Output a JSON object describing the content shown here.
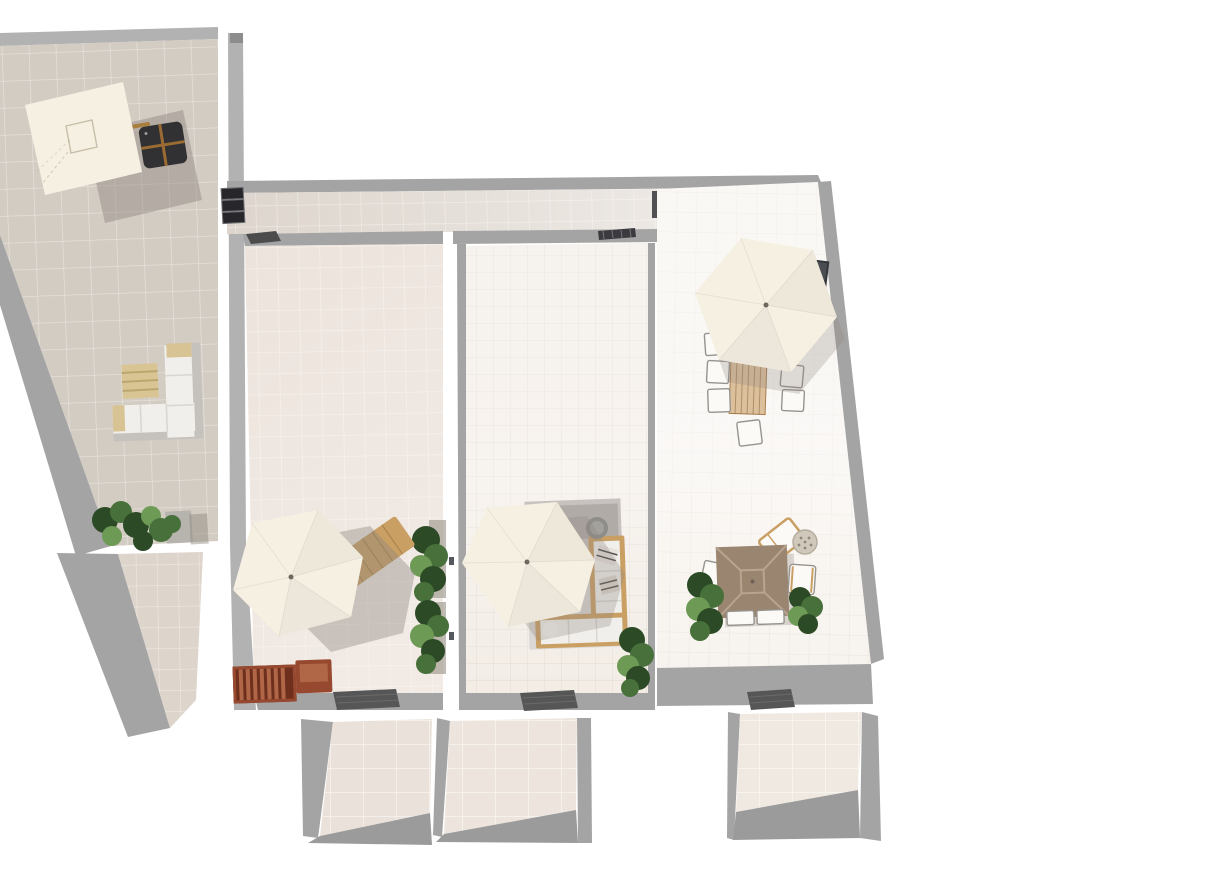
{
  "scene": {
    "title": "3D home-design render — top view of roof terraces with outdoor furniture",
    "view": "top-down orthographic 3D render",
    "background": "#ffffff"
  },
  "colors": {
    "background": "#ffffff",
    "wall_gray": "#a4a4a4",
    "wall_gray_light": "#b2b2b2",
    "wall_gray_dark": "#8d8d8d",
    "floor_gray": "#9b9b9b",
    "tile_left": "#d3ccc3",
    "tile_left_lower": "#ddd4cb",
    "tile_strip": "#ddd5cd",
    "tile_midleft": "#ece3dc",
    "tile_mid": "#f3ede6",
    "tile_right": "#f7f3ee",
    "tile_room_a": "#eae2da",
    "tile_room_b": "#ede5dd",
    "tile_room_c": "#f0e9e1",
    "umbrella": "#f6f0e3",
    "square_canopy": "#9a8570",
    "square_canopy_line": "#b7a491",
    "shadow": "#8e867f",
    "wood": "#c99f63",
    "wood_dark": "#a97f3f",
    "wood_plank": "#dcc09c",
    "crate_red": "#96492f",
    "crate_red_light": "#b06747",
    "crate_red_dark": "#6e2f1d",
    "dark_seat": "#313133",
    "seat_cross": "#9a6b33",
    "sofa_white": "#f1efeb",
    "sofa_frame": "#c5c2be",
    "cushion_tan": "#d7c394",
    "rug_tan": "#d9c593",
    "rug_gray": "#c7c2bf",
    "plant_dark": "#2c4a25",
    "plant": "#47703a",
    "plant_light": "#6d9a55",
    "doormat": "#565656",
    "chair_white": "#fbfaf7",
    "chair_outline": "#97948f",
    "pouf": "#cfc8bb",
    "pouf_dot": "#8e8779",
    "window_dark": "#4a4e52",
    "vent_dark": "#27272b"
  },
  "sections": [
    {
      "id": "terrace-left",
      "label": "slanted left terrace"
    },
    {
      "id": "terrace-left-lower",
      "label": "lower left terrace strip"
    },
    {
      "id": "terrace-strip",
      "label": "upper connecting terrace strip"
    },
    {
      "id": "terrace-mid-left",
      "label": "middle-left terrace"
    },
    {
      "id": "terrace-mid",
      "label": "middle terrace"
    },
    {
      "id": "terrace-right",
      "label": "right terrace"
    },
    {
      "id": "room-a",
      "label": "lower room A"
    },
    {
      "id": "room-b",
      "label": "lower room B"
    },
    {
      "id": "room-c",
      "label": "lower room C"
    }
  ],
  "objects": [
    {
      "id": "cantilever-parasol",
      "section": "terrace-left",
      "kind": "square cream cantilever parasol with arm"
    },
    {
      "id": "dark-lounge-set",
      "section": "terrace-left",
      "kind": "4 dark seats around wooden cross table"
    },
    {
      "id": "white-l-sofa",
      "section": "terrace-left",
      "kind": "L-shaped white outdoor sofa with tan cushions"
    },
    {
      "id": "tan-rug",
      "section": "terrace-left",
      "kind": "striped tan rug"
    },
    {
      "id": "planter-left",
      "section": "terrace-left",
      "kind": "long planter with green plants"
    },
    {
      "id": "wall-vents",
      "section": "terrace-strip",
      "kind": "stack of three dark louver vents"
    },
    {
      "id": "strip-doormat",
      "section": "terrace-strip",
      "kind": "small dark doormat"
    },
    {
      "id": "strip-grill",
      "section": "terrace-strip",
      "kind": "dark wall grill"
    },
    {
      "id": "hex-parasol-1",
      "section": "terrace-mid-left",
      "kind": "hexagonal cream parasol"
    },
    {
      "id": "sun-lounger",
      "section": "terrace-mid-left",
      "kind": "wooden sun lounger under parasol"
    },
    {
      "id": "red-crates",
      "section": "terrace-mid-left",
      "kind": "two reddish wooden crates/benches"
    },
    {
      "id": "plants-column",
      "section": "terrace-mid-left",
      "kind": "two tall plant clusters along wall"
    },
    {
      "id": "doormat-1",
      "section": "terrace-mid-left",
      "kind": "dark doormat"
    },
    {
      "id": "hex-parasol-2",
      "section": "terrace-mid",
      "kind": "hexagonal cream parasol"
    },
    {
      "id": "wood-frame-sofa",
      "section": "terrace-mid",
      "kind": "wood-framed sofa with white cushions"
    },
    {
      "id": "gray-rug",
      "section": "terrace-mid",
      "kind": "gray textured rug"
    },
    {
      "id": "side-table",
      "section": "terrace-mid",
      "kind": "round gray side table"
    },
    {
      "id": "plant-corner",
      "section": "terrace-mid",
      "kind": "plant cluster at lower corner"
    },
    {
      "id": "doormat-2",
      "section": "terrace-mid",
      "kind": "dark doormat"
    },
    {
      "id": "hex-parasol-3",
      "section": "terrace-right",
      "kind": "hexagonal cream parasol over dining set"
    },
    {
      "id": "dining-table",
      "section": "terrace-right",
      "kind": "wooden plank dining table"
    },
    {
      "id": "dining-chairs",
      "section": "terrace-right",
      "kind": "six white square chairs"
    },
    {
      "id": "wall-window",
      "section": "terrace-right",
      "kind": "dark window unit on slanted wall"
    },
    {
      "id": "square-parasol",
      "section": "terrace-right",
      "kind": "square taupe parasol over lounge corner"
    },
    {
      "id": "lounge-chair",
      "section": "terrace-right",
      "kind": "angled wooden lounge chair"
    },
    {
      "id": "woven-pouf",
      "section": "terrace-right",
      "kind": "round woven pouf"
    },
    {
      "id": "white-armchair",
      "section": "terrace-right",
      "kind": "white armchair"
    },
    {
      "id": "plants-right",
      "section": "terrace-right",
      "kind": "two plant clusters"
    },
    {
      "id": "doormat-3",
      "section": "terrace-right",
      "kind": "dark doormat"
    }
  ]
}
